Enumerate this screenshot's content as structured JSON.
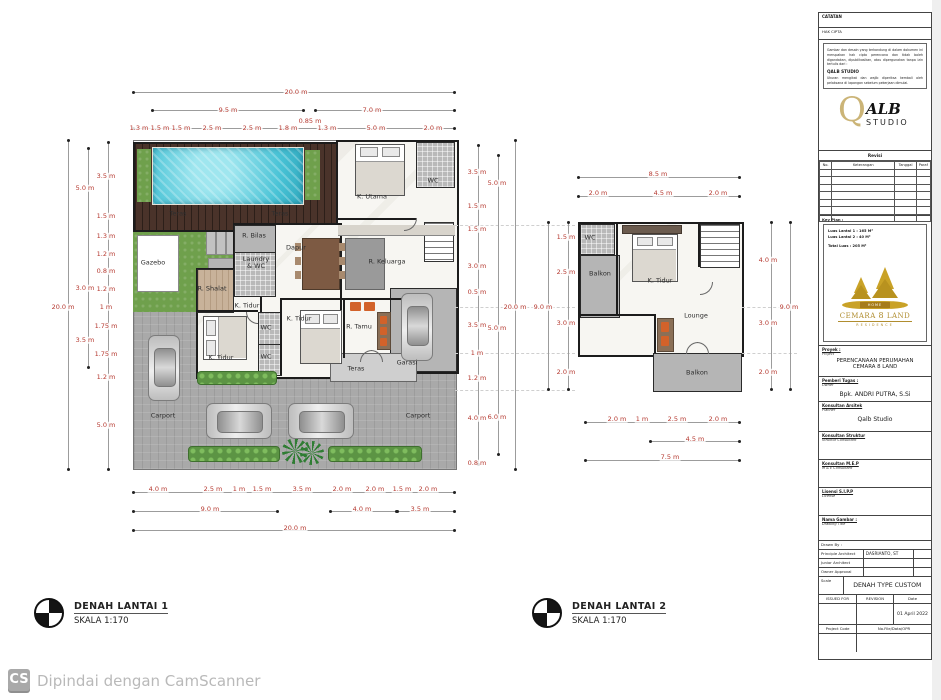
{
  "captions": {
    "plan1": {
      "title": "DENAH LANTAI 1",
      "scale": "SKALA 1:170"
    },
    "plan2": {
      "title": "DENAH LANTAI 2",
      "scale": "SKALA 1:170"
    }
  },
  "footer": {
    "badge": "CS",
    "text": "Dipindai dengan CamScanner"
  },
  "plan1": {
    "rooms": [
      {
        "t": "Teras",
        "x": 178,
        "y": 214
      },
      {
        "t": "Teras",
        "x": 280,
        "y": 214
      },
      {
        "t": "K. Utama",
        "x": 372,
        "y": 197
      },
      {
        "t": "WC",
        "x": 433,
        "y": 181
      },
      {
        "t": "Gazebo",
        "x": 153,
        "y": 263
      },
      {
        "t": "R. Bilas",
        "x": 254,
        "y": 236
      },
      {
        "t": "Laundry & WC",
        "x": 256,
        "y": 263,
        "cls": "wrap"
      },
      {
        "t": "Dapur",
        "x": 296,
        "y": 248
      },
      {
        "t": "R. Keluarga",
        "x": 387,
        "y": 262
      },
      {
        "t": "R. Shalat",
        "x": 212,
        "y": 289
      },
      {
        "t": "K. Tidur",
        "x": 247,
        "y": 306
      },
      {
        "t": "WC",
        "x": 266,
        "y": 328
      },
      {
        "t": "WC",
        "x": 266,
        "y": 357
      },
      {
        "t": "K. Tidur",
        "x": 221,
        "y": 358
      },
      {
        "t": "K. Tidur",
        "x": 299,
        "y": 319
      },
      {
        "t": "R. Tamu",
        "x": 359,
        "y": 327
      },
      {
        "t": "Teras",
        "x": 356,
        "y": 369
      },
      {
        "t": "Garasi",
        "x": 407,
        "y": 363
      },
      {
        "t": "Carport",
        "x": 163,
        "y": 416
      },
      {
        "t": "Carport",
        "x": 418,
        "y": 416
      }
    ],
    "dims_top": [
      {
        "t": "20.0 m",
        "x": 296,
        "y": 92
      },
      {
        "t": "9.5 m",
        "x": 228,
        "y": 110
      },
      {
        "t": "7.0 m",
        "x": 372,
        "y": 110
      },
      {
        "t": "1.3 m",
        "x": 139,
        "y": 128
      },
      {
        "t": "1.5 m",
        "x": 160,
        "y": 128
      },
      {
        "t": "1.5 m",
        "x": 181,
        "y": 128
      },
      {
        "t": "2.5 m",
        "x": 212,
        "y": 128
      },
      {
        "t": "2.5 m",
        "x": 252,
        "y": 128
      },
      {
        "t": "1.8 m",
        "x": 288,
        "y": 128
      },
      {
        "t": "0.85 m",
        "x": 310,
        "y": 121
      },
      {
        "t": "1.3 m",
        "x": 327,
        "y": 128
      },
      {
        "t": "5.0 m",
        "x": 376,
        "y": 128
      },
      {
        "t": "2.0 m",
        "x": 433,
        "y": 128
      }
    ],
    "dims_left": [
      {
        "t": "20.0 m",
        "x": 63,
        "y": 307
      },
      {
        "t": "5.0 m",
        "x": 85,
        "y": 188
      },
      {
        "t": "3.0 m",
        "x": 85,
        "y": 288
      },
      {
        "t": "3.5 m",
        "x": 85,
        "y": 340
      },
      {
        "t": "3.5 m",
        "x": 106,
        "y": 176
      },
      {
        "t": "1.5 m",
        "x": 106,
        "y": 216
      },
      {
        "t": "1.3 m",
        "x": 106,
        "y": 236
      },
      {
        "t": "1.2 m",
        "x": 106,
        "y": 254
      },
      {
        "t": "0.8 m",
        "x": 106,
        "y": 271
      },
      {
        "t": "1.2 m",
        "x": 106,
        "y": 289
      },
      {
        "t": "1 m",
        "x": 106,
        "y": 307
      },
      {
        "t": "1.75 m",
        "x": 106,
        "y": 326
      },
      {
        "t": "1.75 m",
        "x": 106,
        "y": 354
      },
      {
        "t": "1.2 m",
        "x": 106,
        "y": 377
      },
      {
        "t": "5.0 m",
        "x": 106,
        "y": 425
      }
    ],
    "dims_right": [
      {
        "t": "3.5 m",
        "x": 477,
        "y": 172
      },
      {
        "t": "1.5 m",
        "x": 477,
        "y": 206
      },
      {
        "t": "1.5 m",
        "x": 477,
        "y": 229
      },
      {
        "t": "3.0 m",
        "x": 477,
        "y": 266
      },
      {
        "t": "0.5 m",
        "x": 477,
        "y": 292
      },
      {
        "t": "3.5 m",
        "x": 477,
        "y": 325
      },
      {
        "t": "1 m",
        "x": 477,
        "y": 353
      },
      {
        "t": "1.2 m",
        "x": 477,
        "y": 378
      },
      {
        "t": "4.0 m",
        "x": 477,
        "y": 418
      },
      {
        "t": "0.8 m",
        "x": 477,
        "y": 463
      },
      {
        "t": "5.0 m",
        "x": 497,
        "y": 183
      },
      {
        "t": "5.0 m",
        "x": 497,
        "y": 328
      },
      {
        "t": "6.0 m",
        "x": 497,
        "y": 417
      },
      {
        "t": "20.0 m",
        "x": 515,
        "y": 307
      }
    ],
    "dims_bottom": [
      {
        "t": "4.0 m",
        "x": 158,
        "y": 489
      },
      {
        "t": "2.5 m",
        "x": 213,
        "y": 489
      },
      {
        "t": "1 m",
        "x": 239,
        "y": 489
      },
      {
        "t": "1.5 m",
        "x": 262,
        "y": 489
      },
      {
        "t": "3.5 m",
        "x": 302,
        "y": 489
      },
      {
        "t": "2.0 m",
        "x": 342,
        "y": 489
      },
      {
        "t": "2.0 m",
        "x": 375,
        "y": 489
      },
      {
        "t": "1.5 m",
        "x": 402,
        "y": 489
      },
      {
        "t": "2.0 m",
        "x": 428,
        "y": 489
      },
      {
        "t": "9.0 m",
        "x": 210,
        "y": 509
      },
      {
        "t": "4.0 m",
        "x": 362,
        "y": 509
      },
      {
        "t": "3.5 m",
        "x": 420,
        "y": 509
      },
      {
        "t": "20.0 m",
        "x": 295,
        "y": 528
      }
    ]
  },
  "plan2": {
    "rooms": [
      {
        "t": "WC",
        "x": 590,
        "y": 238
      },
      {
        "t": "Balkon",
        "x": 600,
        "y": 274
      },
      {
        "t": "K. Tidur",
        "x": 660,
        "y": 281
      },
      {
        "t": "Lounge",
        "x": 696,
        "y": 316
      },
      {
        "t": "Balkon",
        "x": 697,
        "y": 373
      }
    ],
    "dims_top": [
      {
        "t": "8.5 m",
        "x": 658,
        "y": 174
      },
      {
        "t": "2.0 m",
        "x": 598,
        "y": 193
      },
      {
        "t": "4.5 m",
        "x": 663,
        "y": 193
      },
      {
        "t": "2.0 m",
        "x": 718,
        "y": 193
      }
    ],
    "dims_left": [
      {
        "t": "9.0 m",
        "x": 543,
        "y": 307
      },
      {
        "t": "1.5 m",
        "x": 566,
        "y": 237
      },
      {
        "t": "2.5 m",
        "x": 566,
        "y": 272
      },
      {
        "t": "3.0 m",
        "x": 566,
        "y": 323
      },
      {
        "t": "2.0 m",
        "x": 566,
        "y": 372
      }
    ],
    "dims_right": [
      {
        "t": "4.0 m",
        "x": 768,
        "y": 260
      },
      {
        "t": "3.0 m",
        "x": 768,
        "y": 323
      },
      {
        "t": "2.0 m",
        "x": 768,
        "y": 372
      },
      {
        "t": "9.0 m",
        "x": 789,
        "y": 307
      }
    ],
    "dims_bottom": [
      {
        "t": "2.0 m",
        "x": 617,
        "y": 419
      },
      {
        "t": "1 m",
        "x": 642,
        "y": 419
      },
      {
        "t": "2.5 m",
        "x": 677,
        "y": 419
      },
      {
        "t": "2.0 m",
        "x": 718,
        "y": 419
      },
      {
        "t": "4.5 m",
        "x": 695,
        "y": 439
      },
      {
        "t": "7.5 m",
        "x": 670,
        "y": 457
      }
    ]
  },
  "titleblock": {
    "catatan": "CATATAN",
    "hak_cipta": "HAK CIPTA",
    "copyright": {
      "p1": "Gambar dan desain yang terkandung di dalam dokumen ini merupakan hak cipta perencana dan tidak boleh digandakan, dipublikasikan, atau dipergunakan tanpa izin tertulis dari :",
      "studio": "QALB STUDIO",
      "p2": "Ukuran mengikat dan wajib diperiksa kembali oleh pelaksana di lapangan sebelum pekerjaan dimulai.",
      "p3": "Bila terdapat perbedaan ukuran, segera konfirmasikan kepada perencana untuk mendapatkan keputusan."
    },
    "alb_logo": {
      "q": "Q",
      "alb": "ALB",
      "studio": "STUDIO"
    },
    "revisi": {
      "title": "Revisi",
      "col_no": "No.",
      "col_ket": "Keterangan",
      "col_tgl": "Tanggal",
      "col_paraf": "Paraf"
    },
    "keyplan": {
      "label": "Key Plan :",
      "luas1_label": "Luas Lantai 1",
      "luas1_value": ":  165 M²",
      "luas2_label": "Luas Lantai 2",
      "luas2_value": ":  40 M²",
      "total_label": "Total Luas",
      "total_value": ":  205 M²"
    },
    "cemara": {
      "home": "HOME",
      "name_left": "CEMARA",
      "name_mid": "8",
      "name_right": "LAND",
      "sub": "RESIDENCE"
    },
    "sections": {
      "proyek": {
        "label": "Proyek :",
        "sub": "Project",
        "value1": "PERENCANAAN PERUMAHAN",
        "value2": "CEMARA 8 LAND"
      },
      "pemberi": {
        "label": "Pemberi Tugas :",
        "sub": "Owner",
        "value": "Bpk. ANDRI PUTRA, S.Si"
      },
      "arsitek": {
        "label": "Konsultan Arsitek",
        "sub": "Planner",
        "value": "Qalb Studio"
      },
      "struktur": {
        "label": "Konsultan Struktur",
        "sub": "Struktur Consultant",
        "value": ""
      },
      "mep": {
        "label": "Konsultan M.E.P",
        "sub": "M & E Consultant",
        "value": ""
      },
      "lisensi": {
        "label": "Lisensi S.I.P.P",
        "sub": "License",
        "value": ""
      },
      "gambar": {
        "label": "Nama Gambar :",
        "sub": "Drawing Title",
        "value": ""
      }
    },
    "table": {
      "drawn_by": "Drawn By :",
      "pa_label": "Principle Architect",
      "pa_value": "DASRIANTO, ST",
      "ja_label": "Junior Architect",
      "ja_value": "",
      "oa_label": "Owner Approval",
      "oa_value": "",
      "scale_label": "Scale",
      "scale_value": "DENAH TYPE CUSTOM",
      "issued": "ISSUED FOR",
      "revision": "REVISION",
      "date_label": "Date",
      "date_value": "01 April 2022",
      "project_code": "Project Code",
      "file_no": "No.File/Data/OPR"
    }
  }
}
